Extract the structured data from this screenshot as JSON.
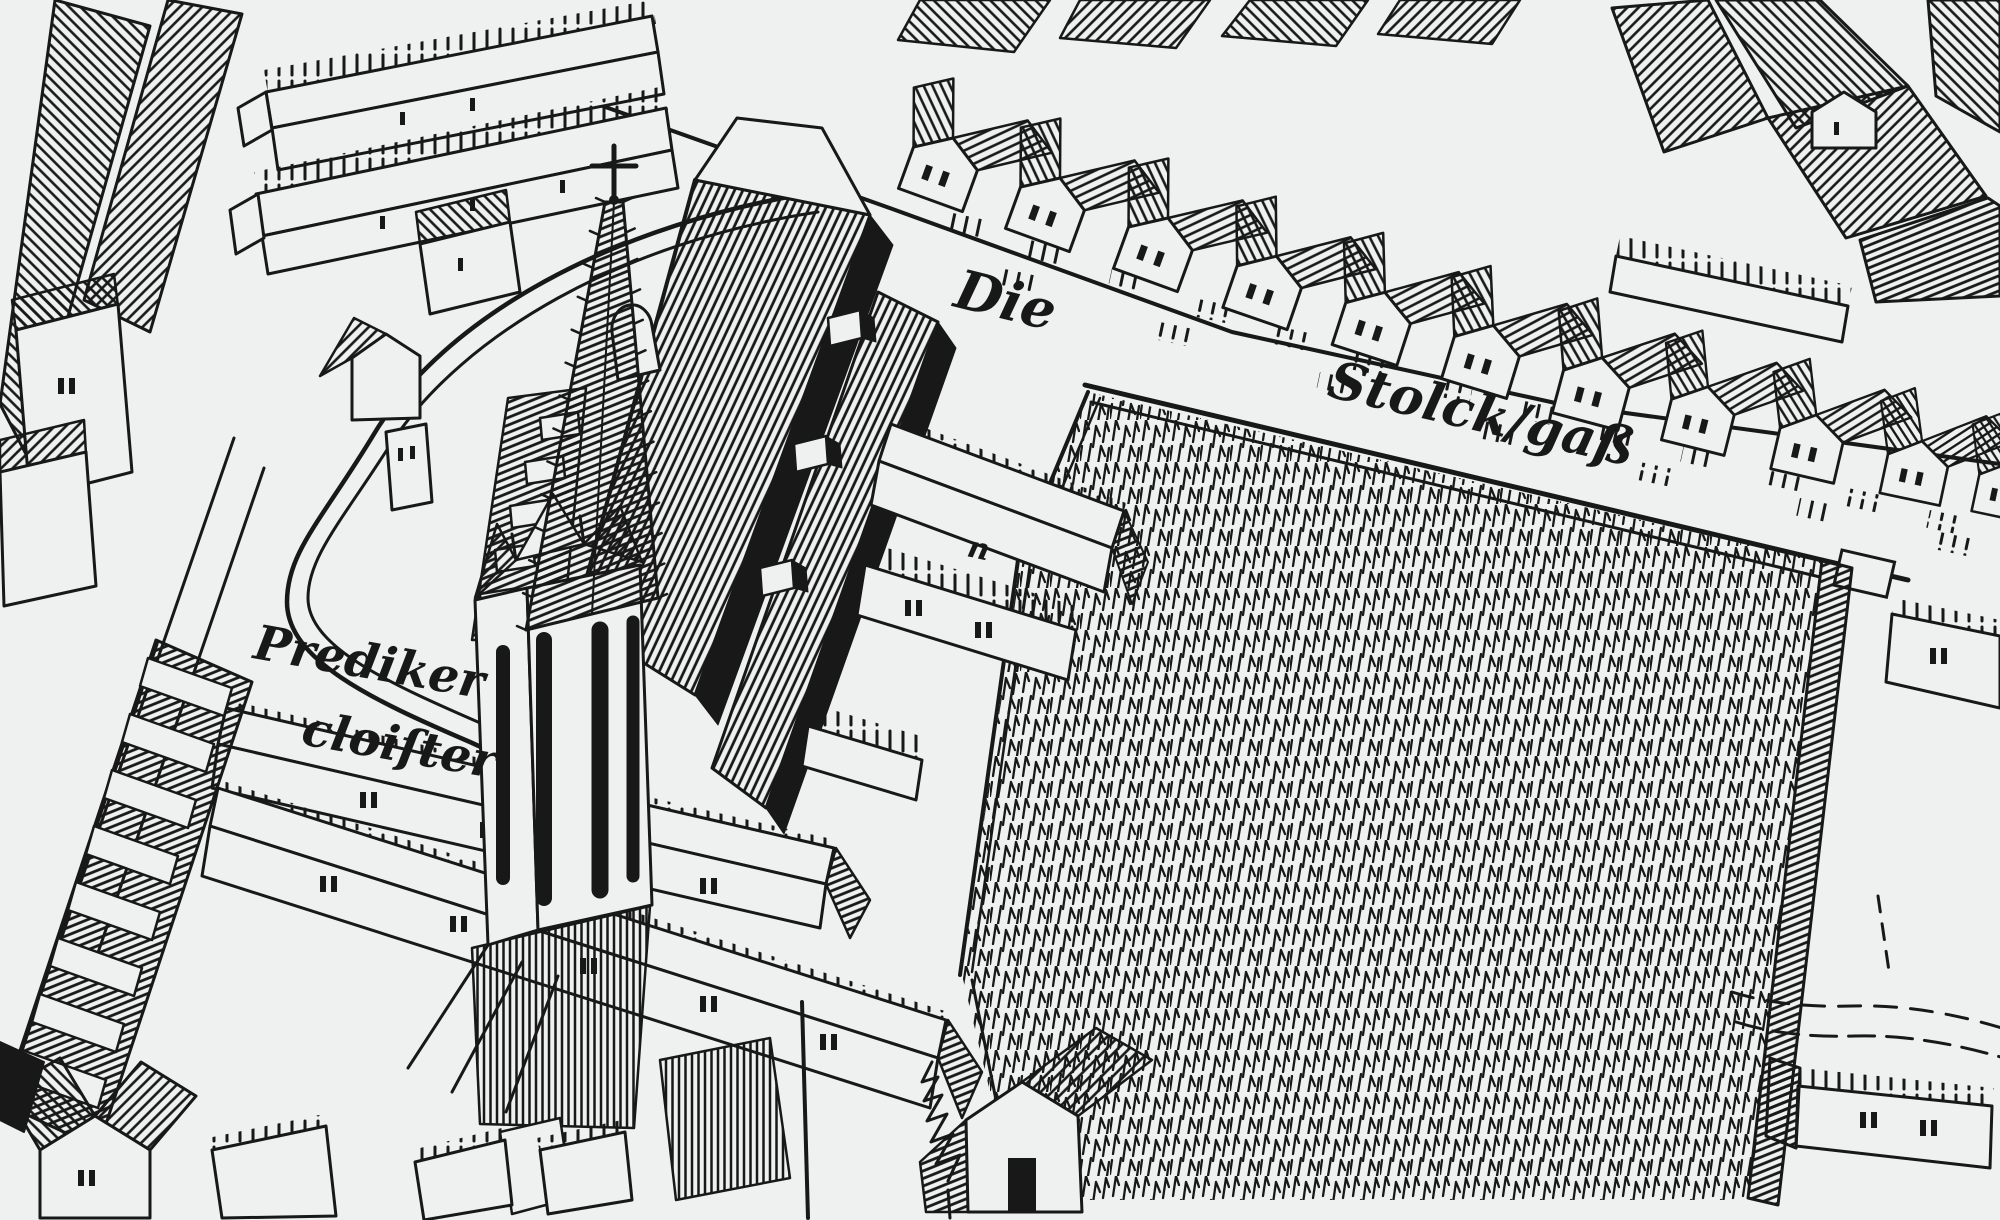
{
  "map": {
    "labels": {
      "street_article": "Die",
      "street_name": "Stolck/gaß",
      "cloister_line1": "Prediker",
      "cloister_line2": "cloiſter",
      "building_mark": "n"
    },
    "colors": {
      "paper": "#eef1ef",
      "ink": "#181818"
    }
  }
}
